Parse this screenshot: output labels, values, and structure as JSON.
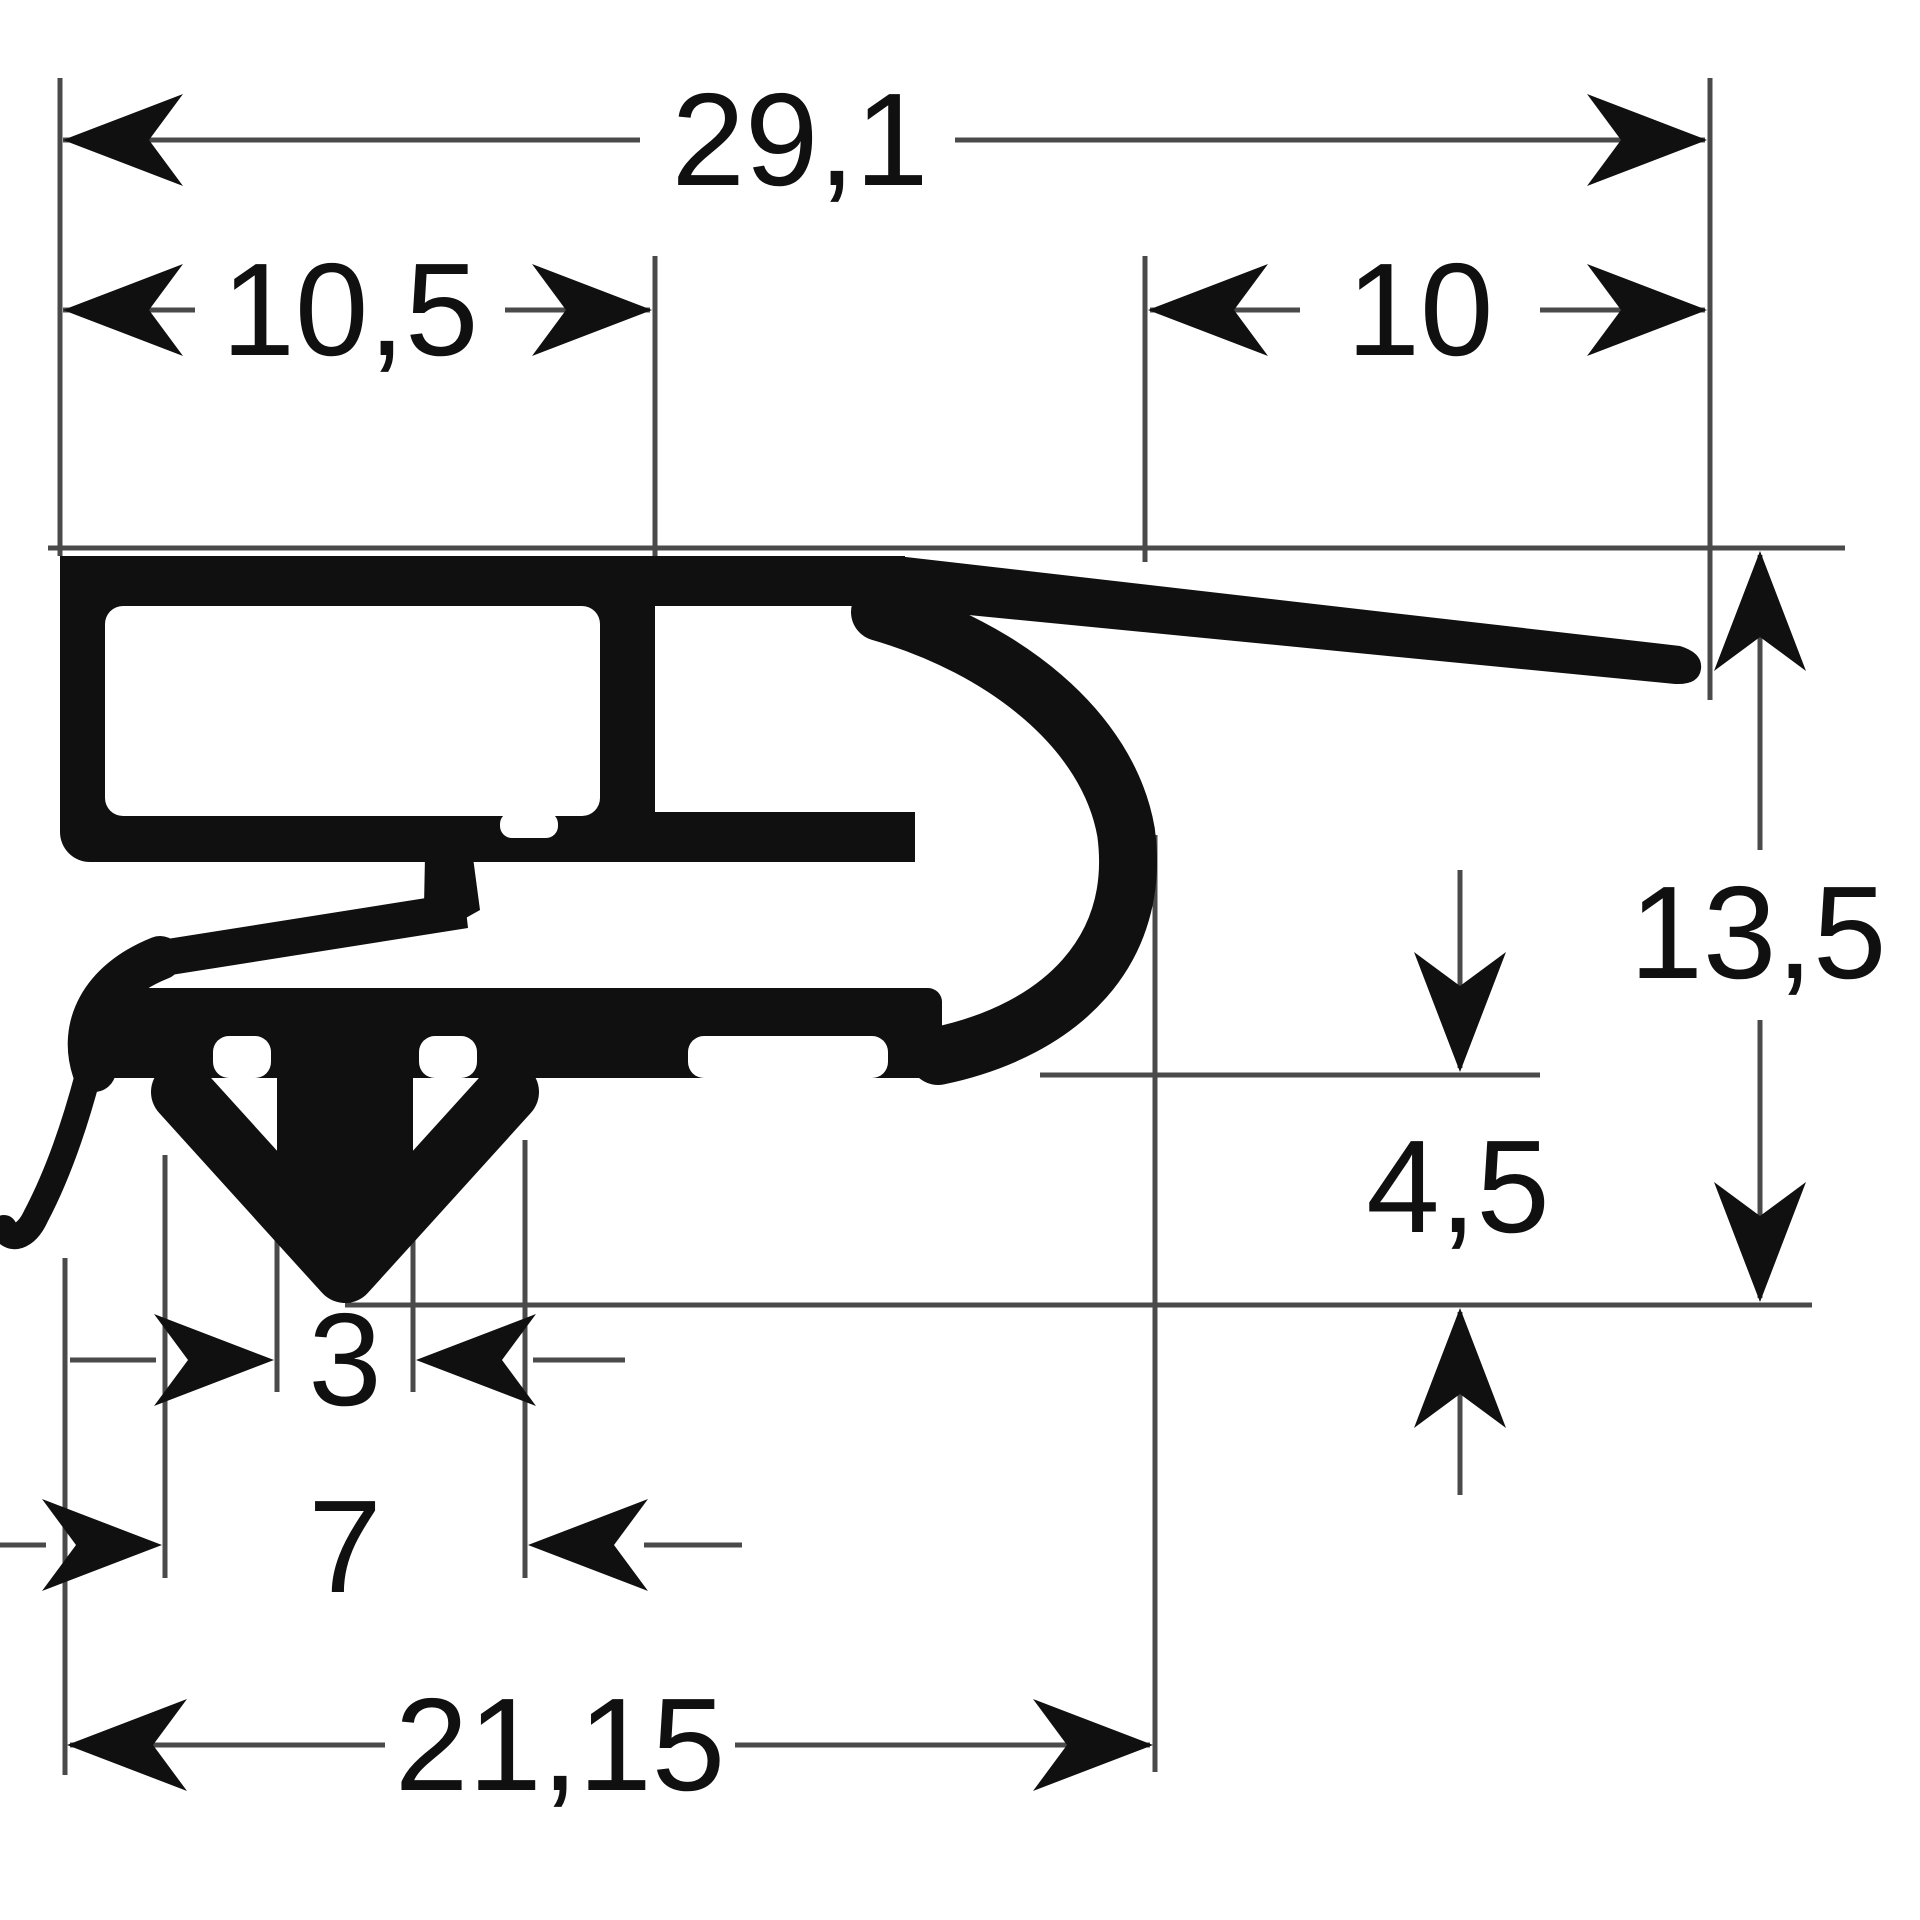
{
  "drawing": {
    "dimensions": {
      "total_width": "29,1",
      "channel_width": "10,5",
      "flap_width": "10",
      "total_height": "13,5",
      "foot_to_tip_height": "4,5",
      "stem_width": "3",
      "barb_width": "7",
      "body_width": "21,15"
    },
    "colors": {
      "ink": "#101010",
      "line": "#4a4a4a",
      "background": "#ffffff"
    }
  }
}
